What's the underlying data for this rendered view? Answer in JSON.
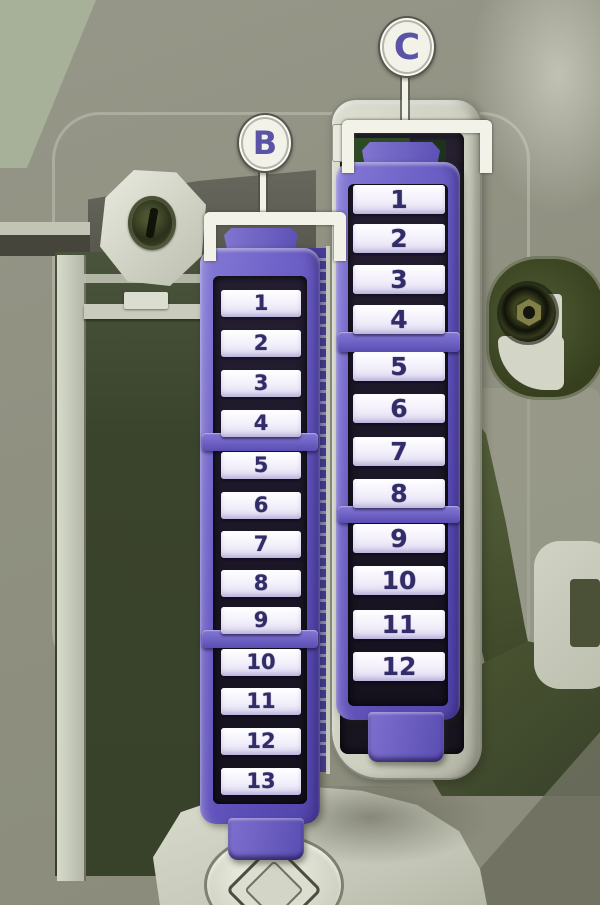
{
  "callouts": {
    "b": {
      "label": "B"
    },
    "c": {
      "label": "C"
    }
  },
  "fuse_blocks": [
    {
      "id": "B",
      "callout": "B",
      "fuse_groups": [
        [
          "1",
          "2",
          "3",
          "4"
        ],
        [
          "5",
          "6",
          "7",
          "8",
          "9"
        ],
        [
          "10",
          "11",
          "12",
          "13"
        ]
      ]
    },
    {
      "id": "C",
      "callout": "C",
      "fuse_groups": [
        [
          "1",
          "2",
          "3",
          "4"
        ],
        [
          "5",
          "6",
          "7",
          "8"
        ],
        [
          "9",
          "10",
          "11",
          "12"
        ]
      ]
    }
  ],
  "colors": {
    "connector_purple": "#6a5dc4",
    "connector_purple_dark": "#4a3f9e",
    "slot_white": "#f3f1fa",
    "number_ink": "#322d68",
    "callout_letter": "#5a53a6",
    "background_olive": "#8f9080",
    "panel_green": "#3f4830",
    "housing_gray": "#d4d6c8"
  }
}
